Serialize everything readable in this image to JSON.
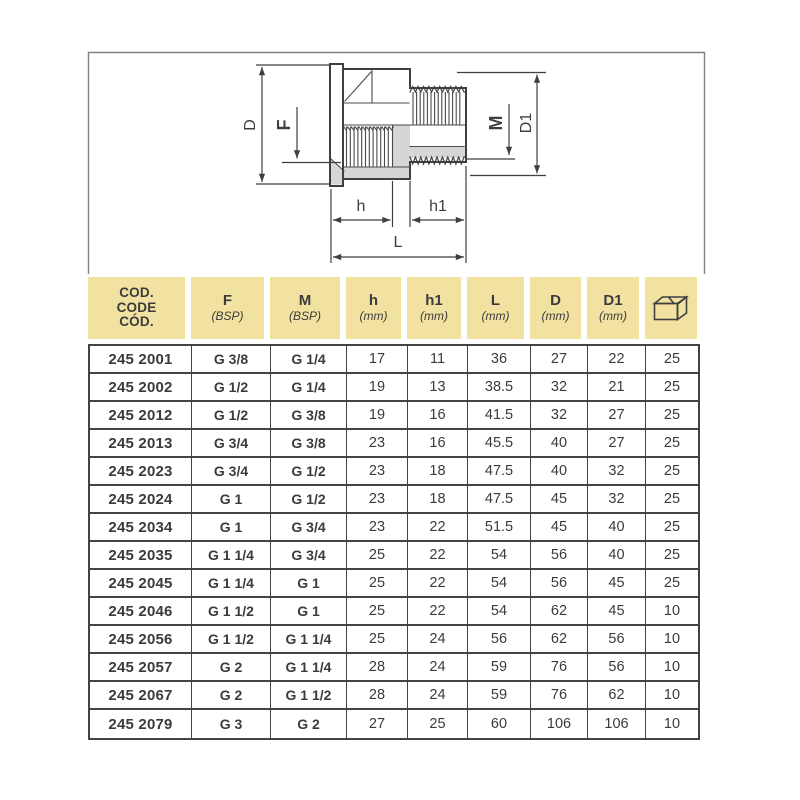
{
  "page": {
    "type": "catalog-sheet-reducing-fitting"
  },
  "diagram": {
    "labels": {
      "d": "D",
      "f": "F",
      "m": "M",
      "d1": "D1",
      "h": "h",
      "h1": "h1",
      "l": "L"
    },
    "colors": {
      "line": "#3f3f3f",
      "section_gray": "#d6d6d6",
      "frame": "#818181"
    }
  },
  "table": {
    "colors": {
      "header_bg": "#f2e2a2",
      "grid": "#434343",
      "text": "#3b3b3b"
    },
    "code_header": [
      "COD.",
      "CODE",
      "CÓD."
    ],
    "headers": [
      {
        "name": "F",
        "unit": "(BSP)"
      },
      {
        "name": "M",
        "unit": "(BSP)"
      },
      {
        "name": "h",
        "unit": "(mm)"
      },
      {
        "name": "h1",
        "unit": "(mm)"
      },
      {
        "name": "L",
        "unit": "(mm)"
      },
      {
        "name": "D",
        "unit": "(mm)"
      },
      {
        "name": "D1",
        "unit": "(mm)"
      }
    ],
    "package_icon": "box-icon",
    "rows": [
      [
        "245 2001",
        "G 3/8",
        "G 1/4",
        "17",
        "11",
        "36",
        "27",
        "22",
        "25"
      ],
      [
        "245 2002",
        "G 1/2",
        "G 1/4",
        "19",
        "13",
        "38.5",
        "32",
        "21",
        "25"
      ],
      [
        "245 2012",
        "G 1/2",
        "G 3/8",
        "19",
        "16",
        "41.5",
        "32",
        "27",
        "25"
      ],
      [
        "245 2013",
        "G 3/4",
        "G 3/8",
        "23",
        "16",
        "45.5",
        "40",
        "27",
        "25"
      ],
      [
        "245 2023",
        "G 3/4",
        "G 1/2",
        "23",
        "18",
        "47.5",
        "40",
        "32",
        "25"
      ],
      [
        "245 2024",
        "G 1",
        "G 1/2",
        "23",
        "18",
        "47.5",
        "45",
        "32",
        "25"
      ],
      [
        "245 2034",
        "G 1",
        "G 3/4",
        "23",
        "22",
        "51.5",
        "45",
        "40",
        "25"
      ],
      [
        "245 2035",
        "G 1 1/4",
        "G 3/4",
        "25",
        "22",
        "54",
        "56",
        "40",
        "25"
      ],
      [
        "245 2045",
        "G 1 1/4",
        "G 1",
        "25",
        "22",
        "54",
        "56",
        "45",
        "25"
      ],
      [
        "245 2046",
        "G 1 1/2",
        "G 1",
        "25",
        "22",
        "54",
        "62",
        "45",
        "10"
      ],
      [
        "245 2056",
        "G 1 1/2",
        "G 1 1/4",
        "25",
        "24",
        "56",
        "62",
        "56",
        "10"
      ],
      [
        "245 2057",
        "G 2",
        "G 1 1/4",
        "28",
        "24",
        "59",
        "76",
        "56",
        "10"
      ],
      [
        "245 2067",
        "G 2",
        "G 1 1/2",
        "28",
        "24",
        "59",
        "76",
        "62",
        "10"
      ],
      [
        "245 2079",
        "G 3",
        "G 2",
        "27",
        "25",
        "60",
        "106",
        "106",
        "10"
      ]
    ]
  }
}
